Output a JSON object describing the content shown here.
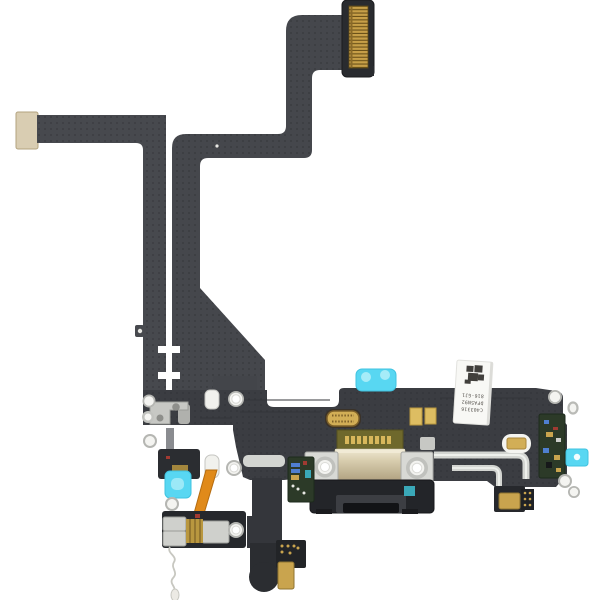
{
  "meta": {
    "title": "Product photo: smartphone charging port flex cable assembly (black), white background",
    "background": "#ffffff"
  },
  "label": {
    "has_datamatrix_code": true,
    "orientation": "text rotated 180deg, label tilted ~4deg",
    "lines": [
      "C403316",
      "DFA5N92",
      "816-GJ1"
    ]
  },
  "colors": {
    "flex": "#45474c",
    "flex_body": "#3b3d42",
    "flex_dark": "#26282c",
    "housing_dark": "#232529",
    "gold": "#d2ae56",
    "gold_pins": "#c79f48",
    "mic_gold": "#c9a44e",
    "stiffener_tan": "#d9cdb2",
    "shield_champagne": "#d8cdae",
    "cyan": "#58d7f2",
    "cyan_light": "#a6ecf8",
    "orange": "#e08a1a",
    "pcb_green": "#2c3a28",
    "pcb_olive": "#6e682c",
    "silver": "#d3d5d1",
    "ring_white": "#f4f4f1",
    "label_bg": "#f8f8f5",
    "wire_white": "#c7c7c0"
  },
  "parts": [
    {
      "name": "board-to-board-connector",
      "desc": "black connector block with gold pin grid, top right"
    },
    {
      "name": "upper-flex-ribbon",
      "desc": "S-shaped dark flex ribbon from top connector down to main board"
    },
    {
      "name": "left-flex-arm",
      "desc": "long horizontal flex arm with tan stiffener end cap"
    },
    {
      "name": "narrow-vertical-ribbon",
      "desc": "perforated narrow ribbon running down left-center"
    },
    {
      "name": "main-board",
      "desc": "wide black flex board of the charging-port assembly"
    },
    {
      "name": "lightning-connector",
      "desc": "champagne metal shielded charging connector with two screw brackets"
    },
    {
      "name": "port-housing",
      "desc": "black plastic port housing with lightning opening"
    },
    {
      "name": "gold-b2b-socket",
      "desc": "small gold oval board-to-board socket"
    },
    {
      "name": "gold-contact-pads",
      "desc": "two gold rectangular contact pads"
    },
    {
      "name": "white-barcode-label",
      "desc": "white sticker with datamatrix code and part numbers"
    },
    {
      "name": "cyan-pull-tabs",
      "desc": "cyan adhesive pull tabs (top, left, right)"
    },
    {
      "name": "orange-flex",
      "desc": "small orange flex ribbon, lower left"
    },
    {
      "name": "wifi-antenna-modules",
      "desc": "lower-left solder modules with silver pads"
    },
    {
      "name": "microphones",
      "desc": "gold microphone components, bottom center and right"
    },
    {
      "name": "screw-standoffs",
      "desc": "white/silver screw rings and standoffs"
    },
    {
      "name": "antenna-wire",
      "desc": "thin white antenna wire trailing bottom left"
    },
    {
      "name": "green-pcb-sections",
      "desc": "green PCB areas with tiny components"
    },
    {
      "name": "silver-antenna-traces",
      "desc": "bright silver L-shaped traces on right half"
    }
  ]
}
